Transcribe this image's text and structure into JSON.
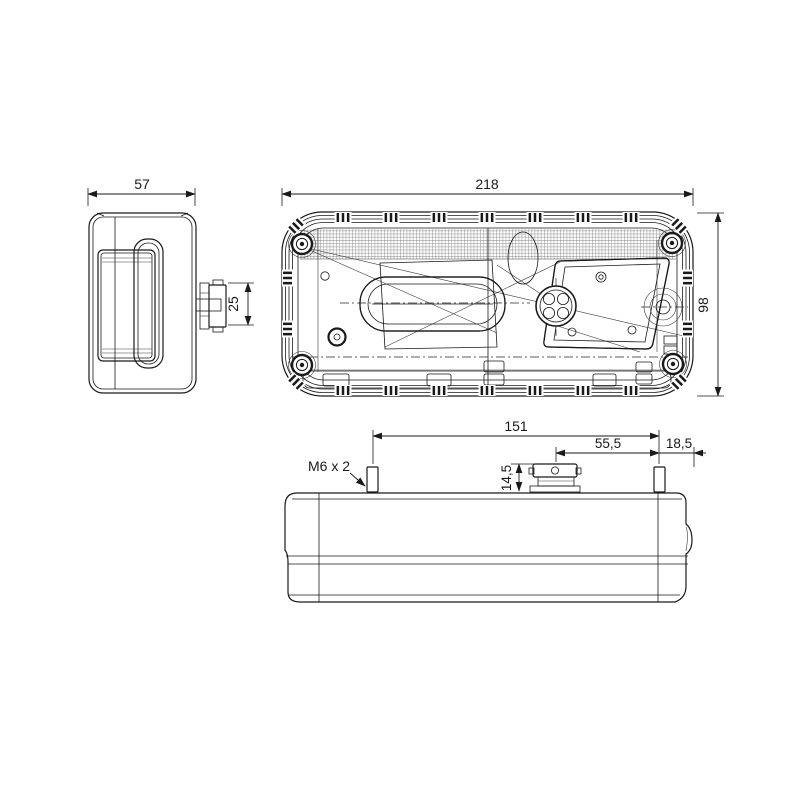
{
  "drawing": {
    "background": "#ffffff",
    "line_color": "#1a1a1a",
    "views": {
      "side": {
        "dims": {
          "width": "57",
          "connector_depth": "25"
        }
      },
      "front": {
        "dims": {
          "width": "218",
          "height": "98"
        }
      },
      "bottom": {
        "dims": {
          "stud_spacing": "151",
          "connector_to_stud": "55,5",
          "stud_to_edge": "18,5",
          "connector_height": "14,5"
        },
        "labels": {
          "stud_thread": "M6 x 2"
        }
      }
    }
  }
}
